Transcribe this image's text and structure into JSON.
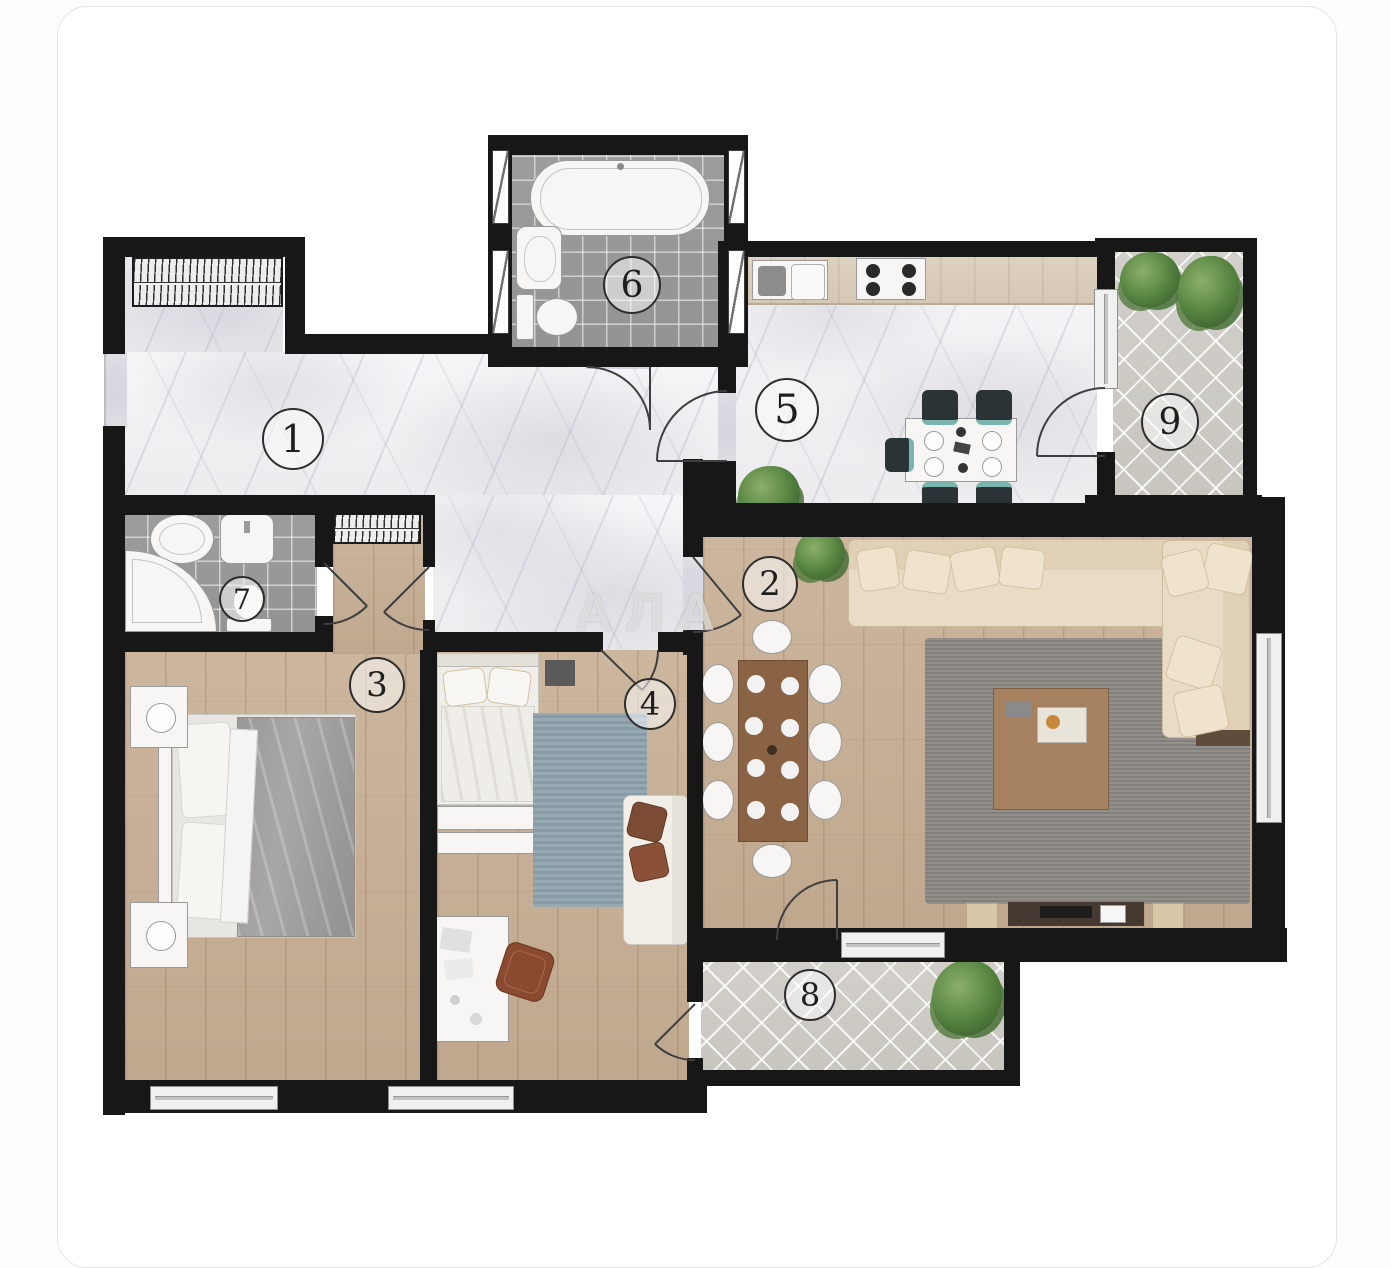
{
  "watermark": "АЛА",
  "plan": {
    "title_hint": "apartment floor plan, top-down render",
    "colors": {
      "wall": "#171717",
      "marble_floor": "#f3f2f4",
      "wood_floor": "#c8b39c",
      "bath_tile": "#9c9c9c",
      "balcony_paver": "#d0cdc8",
      "sofa_beige": "#e9dcc6",
      "rug_gray": "#8d8a85",
      "rug_blue": "#8ea3ad",
      "plant_green": "#53803e",
      "kitchen_chair": "#2b3337"
    },
    "rooms": [
      {
        "number": "1",
        "type": "hallway",
        "floor": "marble",
        "furniture": [
          "wardrobe"
        ]
      },
      {
        "number": "2",
        "type": "living-room",
        "floor": "wood",
        "furniture": [
          "corner-sofa",
          "gray-rug",
          "coffee-table",
          "dining-table-8-chairs",
          "tv-console",
          "plant"
        ]
      },
      {
        "number": "3",
        "type": "bedroom",
        "floor": "wood",
        "furniture": [
          "double-bed",
          "nightstands-with-lamps",
          "wardrobe"
        ]
      },
      {
        "number": "4",
        "type": "bedroom-office",
        "floor": "wood",
        "furniture": [
          "single-bed",
          "blue-rug",
          "loveseat",
          "desk",
          "chair"
        ]
      },
      {
        "number": "5",
        "type": "kitchen-dining",
        "floor": "marble",
        "furniture": [
          "counter-with-sink-and-stove",
          "dining-table-4-chairs",
          "plant"
        ]
      },
      {
        "number": "6",
        "type": "bathroom",
        "floor": "tile",
        "furniture": [
          "bathtub",
          "sink",
          "toilet"
        ]
      },
      {
        "number": "7",
        "type": "bathroom",
        "floor": "tile",
        "furniture": [
          "corner-shower",
          "sink",
          "basin",
          "toilet"
        ]
      },
      {
        "number": "8",
        "type": "balcony",
        "floor": "paver",
        "furniture": [
          "plant"
        ]
      },
      {
        "number": "9",
        "type": "balcony",
        "floor": "paver",
        "furniture": [
          "plants"
        ]
      }
    ]
  }
}
